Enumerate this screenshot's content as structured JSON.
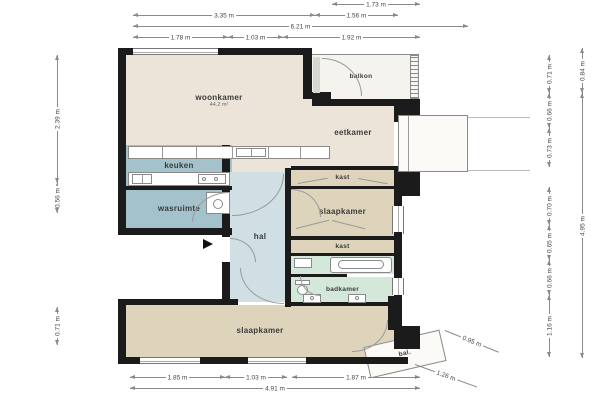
{
  "plan": {
    "rooms": [
      {
        "label": "woonkamer",
        "area": "44.2 m²"
      },
      {
        "label": "balkon"
      },
      {
        "label": "eetkamer"
      },
      {
        "label": "keuken"
      },
      {
        "label": "wasruimte"
      },
      {
        "label": "hal"
      },
      {
        "label": "kast"
      },
      {
        "label": "slaapkamer"
      },
      {
        "label": "kast"
      },
      {
        "label": "badkamer"
      },
      {
        "label": "slaapkamer"
      },
      {
        "label": "bal."
      }
    ],
    "dimensions": {
      "top": [
        "1.73 m",
        "3.35 m",
        "1.56 m",
        "6.21 m",
        "1.78 m",
        "1.03 m",
        "1.92 m"
      ],
      "bottom": [
        "1.85 m",
        "1.03 m",
        "1.87 m",
        "4.91 m"
      ],
      "left": [
        "2.39 m",
        "0.56 m",
        "0.71 m"
      ],
      "right_inner": [
        "0.71 m",
        "0.66 m",
        "0.73 m",
        "0.70 m",
        "0.65 m",
        "0.66 m",
        "1.16 m"
      ],
      "right_outer": [
        "0.84 m",
        "4.95 m"
      ],
      "diagonal": [
        "0.95 m",
        "1.26 m"
      ]
    },
    "colors": {
      "wall": "#1b1b1b",
      "living": "#ece4d8",
      "bedroom": "#ded3bb",
      "kitchen": "#a3c2cb",
      "hall": "#cfdfe4",
      "bathroom": "#d4e8da",
      "balcony": "#f4f3ee"
    }
  }
}
